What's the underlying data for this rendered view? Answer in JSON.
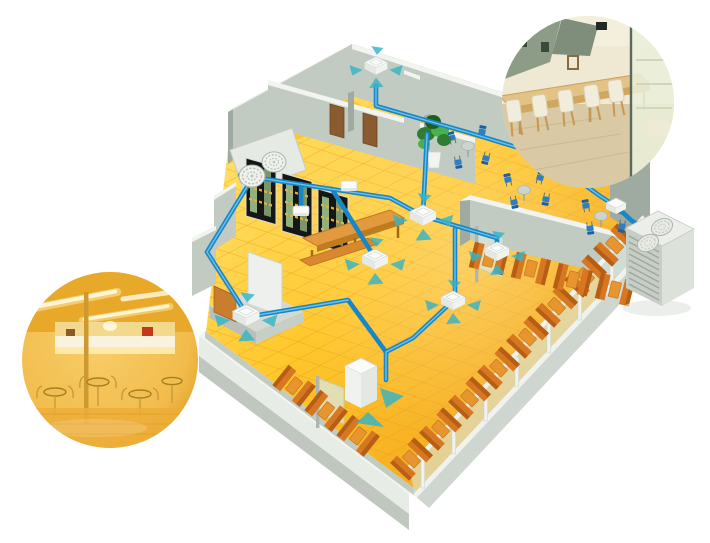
{
  "meta": {
    "description": "Cutaway 3D illustration of a restaurant interior with a multi-split air-conditioning system: blue refrigerant piping connects ceiling cassette indoor units (with four-way airflow arrows) to a twin-fan outdoor condensing unit; two circular photo insets show real cafe interiors.",
    "type": "marketing illustration, no visible text"
  },
  "colors": {
    "background": "#FFFFFF",
    "floor_base": "#FFC72B",
    "floor_light": "#FFE06A",
    "floor_deep": "#F2A41D",
    "floor_line": "#E59D18",
    "wall_face": "#C2CBC2",
    "wall_face_dark": "#9FAAA1",
    "wall_top": "#F1F4F0",
    "wall_inner": "#ADB8AF",
    "wall_outer": "#E8ECE7",
    "wall_shadow": "#BFC7BF",
    "pipe": "#1787C7",
    "pipe_light": "#7AC6EC",
    "airflow": "#36B3C6",
    "unit_white": "#FAFBFA",
    "unit_shade": "#E3E8E4",
    "unit_edge": "#C9D1CC",
    "wood": "#E39A3E",
    "wood_dark": "#C07A20",
    "bench": "#D87721",
    "bench_dark": "#B65E14",
    "table_small": "#E8952F",
    "chair_blue": "#2E7EC2",
    "chair_blue_dark": "#1E5F9E",
    "glass": "#D9EAE2",
    "glass_frame": "#EFF2EE",
    "shelf_black": "#161616",
    "bottle_green": "#A6CC8F",
    "bottle_amber": "#E2B13C",
    "plant_green": "#2F7D33",
    "plant_green_light": "#4CAF50",
    "pot_white": "#F2F4F0",
    "door_brown": "#8A5A30",
    "gray_table": "#CDD4D0",
    "outdoor_body": "#ECEFE9",
    "outdoor_side": "#DCE1DA",
    "outdoor_louver_face": "#C7CEC6",
    "outdoor_louver_line": "#9FA89F",
    "fan_ring": "#B9C2B9",
    "pr_bg": "#E9E2CC",
    "pr_floor": "#D9C9A4",
    "pr_wall": "#EFE8D2",
    "pr_panel": "#8C9C86",
    "pr_table": "#E3C285",
    "pr_table_edge": "#CFA75F",
    "pr_chair": "#F2ECDA",
    "pr_chair_leg": "#C89850",
    "pr_glass": "#EAF0DA",
    "pr_frame": "#5A6A5E",
    "pr_dark": "#3A4A3A",
    "pl_mid": "#F2BC4C",
    "pl_edge": "#DD9A1F",
    "pl_ceiling": "#E8A82A",
    "pl_light": "#FFF6D6",
    "pl_glow": "#FFE9A8",
    "pl_counter": "#F8F2DF",
    "pl_red": "#C23A1A",
    "pl_wire": "#C79A3A",
    "pl_pole": "#CE9A30",
    "pl_floor": "#EDAE38",
    "pl_seam": "#D89828"
  },
  "equipment": {
    "indoor_cassette_count": 6,
    "wall_unit_count": 2,
    "floor_console_count": 1,
    "pipe_junction_count": 1,
    "ventilation_fan_count": 2,
    "outdoor_unit_count": 1,
    "cassette_label": "ceiling cassette indoor unit with four-way airflow arrows",
    "wall_unit_label": "wall-mounted indoor unit",
    "console_label": "floor console indoor unit",
    "fan_label": "roof ventilation fan",
    "outdoor_label": "outdoor condensing unit with twin top fans and side louvers",
    "piping_label": "blue refrigerant piping network"
  },
  "furniture": {
    "booth_count": 15,
    "dining_chair_count": 12,
    "round_table_count": 3,
    "display_shelf_count": 3,
    "glass_screen_count": 3,
    "door_count": 2,
    "booth_label": "window booth with two benches and table",
    "shelf_label": "dark display shelf with bottles",
    "counter_label": "long wooden counter table",
    "plant_label": "potted plant"
  },
  "insets": {
    "right": {
      "label": "circular photo inset: cafe interior with cream chairs, long wooden table and glass partition"
    },
    "left": {
      "label": "circular photo inset: cafe interior in warm amber lighting with wire chairs and counter"
    }
  }
}
